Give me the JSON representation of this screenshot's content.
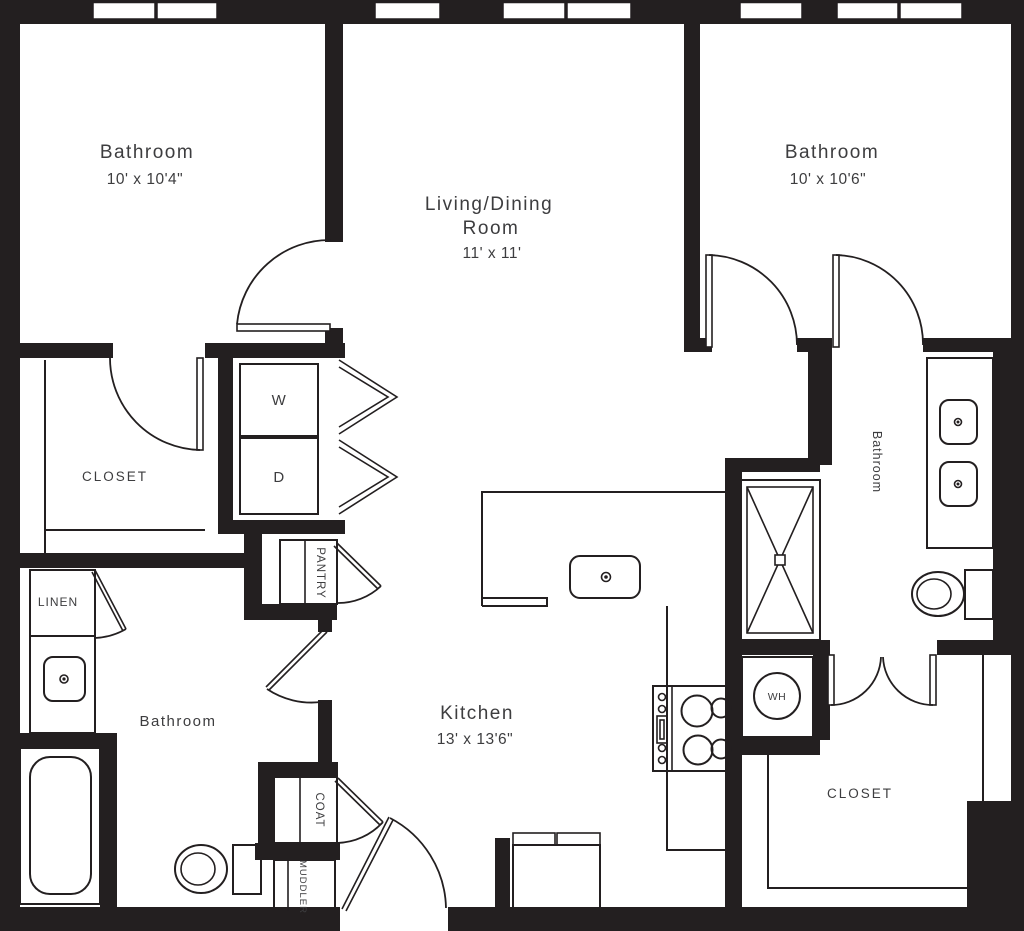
{
  "plan": {
    "bedroom_tl": {
      "label": "Bathroom",
      "dims": "10' x 10'4\""
    },
    "living": {
      "line1": "Living/Dining",
      "line2": "Room",
      "dims": "11' x 11'"
    },
    "bedroom_tr": {
      "label": "Bathroom",
      "dims": "10' x 10'6\""
    },
    "closet_tl": {
      "label": "CLOSET"
    },
    "washer": {
      "label": "W"
    },
    "dryer": {
      "label": "D"
    },
    "pantry": {
      "label": "PANTRY"
    },
    "linen": {
      "label": "LINEN"
    },
    "bathroom_left": {
      "label": "Bathroom"
    },
    "kitchen": {
      "label": "Kitchen",
      "dims": "13' x 13'6\""
    },
    "coat": {
      "label": "COAT"
    },
    "muddler": {
      "label": "MUDDLER"
    },
    "water_heater": {
      "label": "WH"
    },
    "closet_br": {
      "label": "CLOSET"
    },
    "bathroom_right": {
      "label": "Bathroom"
    }
  },
  "colors": {
    "wall": "#231f20",
    "text": "#3d3d3f",
    "background": "#ffffff"
  }
}
